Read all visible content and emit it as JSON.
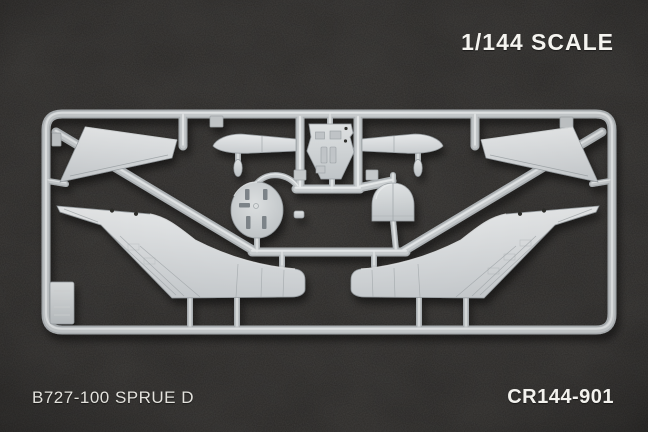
{
  "photo": {
    "scale_label": "1/144 SCALE",
    "footer_left_label": "B727-100 SPRUE D",
    "footer_right_label": "CR144-901"
  },
  "subject": {
    "kit_scale": "1/144",
    "aircraft": "B727-100",
    "sprue_letter": "D",
    "product_code": "CR144-901",
    "parts": [
      "left-horizontal-stabilizer",
      "right-horizontal-stabilizer",
      "cockpit-floor",
      "left-nacelle-cone-half",
      "right-nacelle-cone-half",
      "cabin-bulkhead-disc",
      "dome-bulkhead",
      "left-rear-fuselage-fin-half",
      "right-rear-fuselage-fin-half",
      "small-antenna-part-left",
      "small-antenna-part-right",
      "small-clip-part",
      "blank-molding-tag"
    ]
  },
  "colors": {
    "background_fabric": "#343230",
    "plastic_base": "#c6cacc",
    "plastic_highlight": "#e9ebec",
    "plastic_shadow": "#9aa0a4",
    "label_text": "#f5f4f0"
  }
}
